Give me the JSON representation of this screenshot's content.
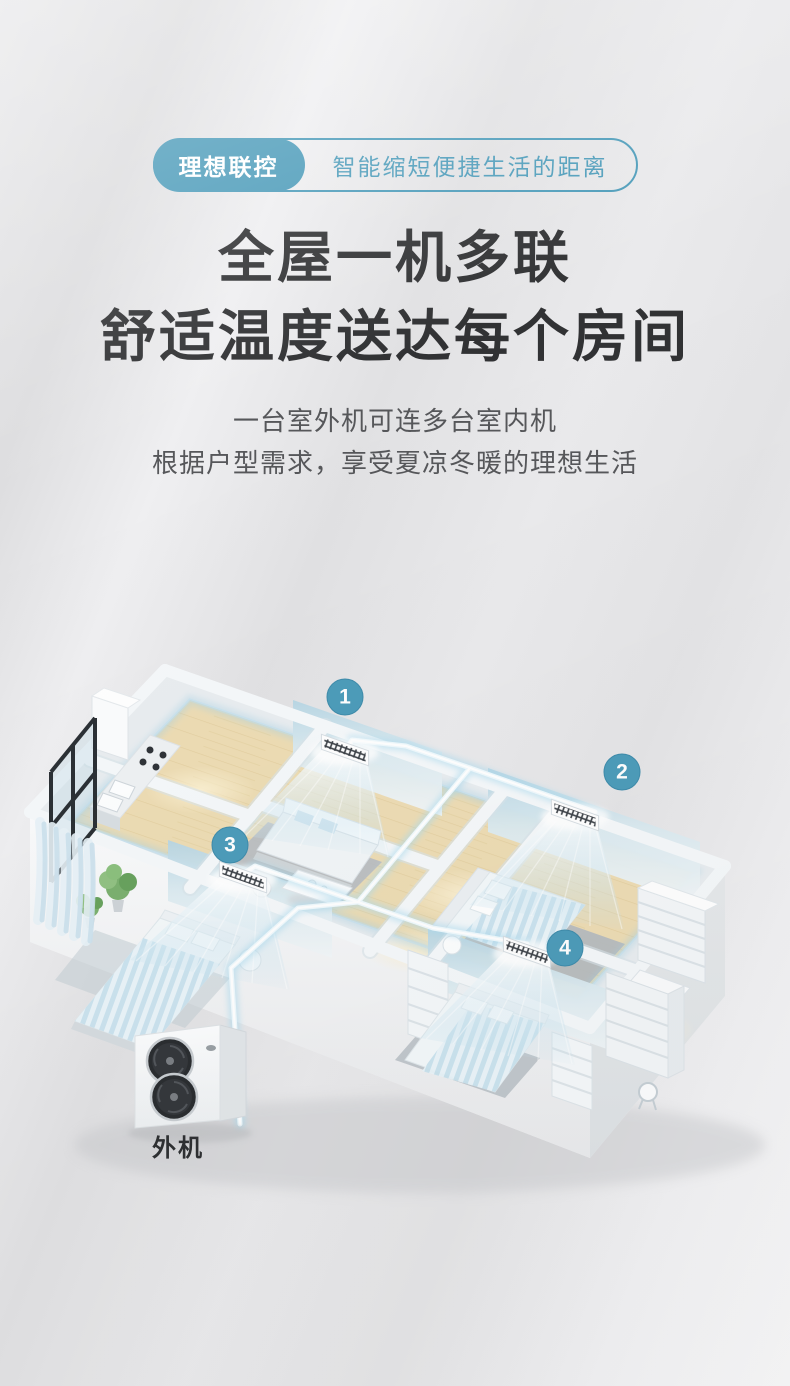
{
  "badge_bar": {
    "tag": "理想联控",
    "tagline": "智能缩短便捷生活的距离"
  },
  "heading": {
    "line1": "全屋一机多联",
    "line2": "舒适温度送达每个房间"
  },
  "subheading": {
    "line1": "一台室外机可连多台室内机",
    "line2": "根据户型需求，享受夏凉冬暖的理想生活"
  },
  "illustration": {
    "units": [
      {
        "number": "1"
      },
      {
        "number": "2"
      },
      {
        "number": "3"
      },
      {
        "number": "4"
      }
    ],
    "outdoor_unit_label": "外机",
    "colors": {
      "accent": "#4d9cba",
      "pipe_core": "#ffffff",
      "pipe_glow": "#aedcef",
      "heading_text": "#313234",
      "subheading_text": "#56575a"
    }
  }
}
